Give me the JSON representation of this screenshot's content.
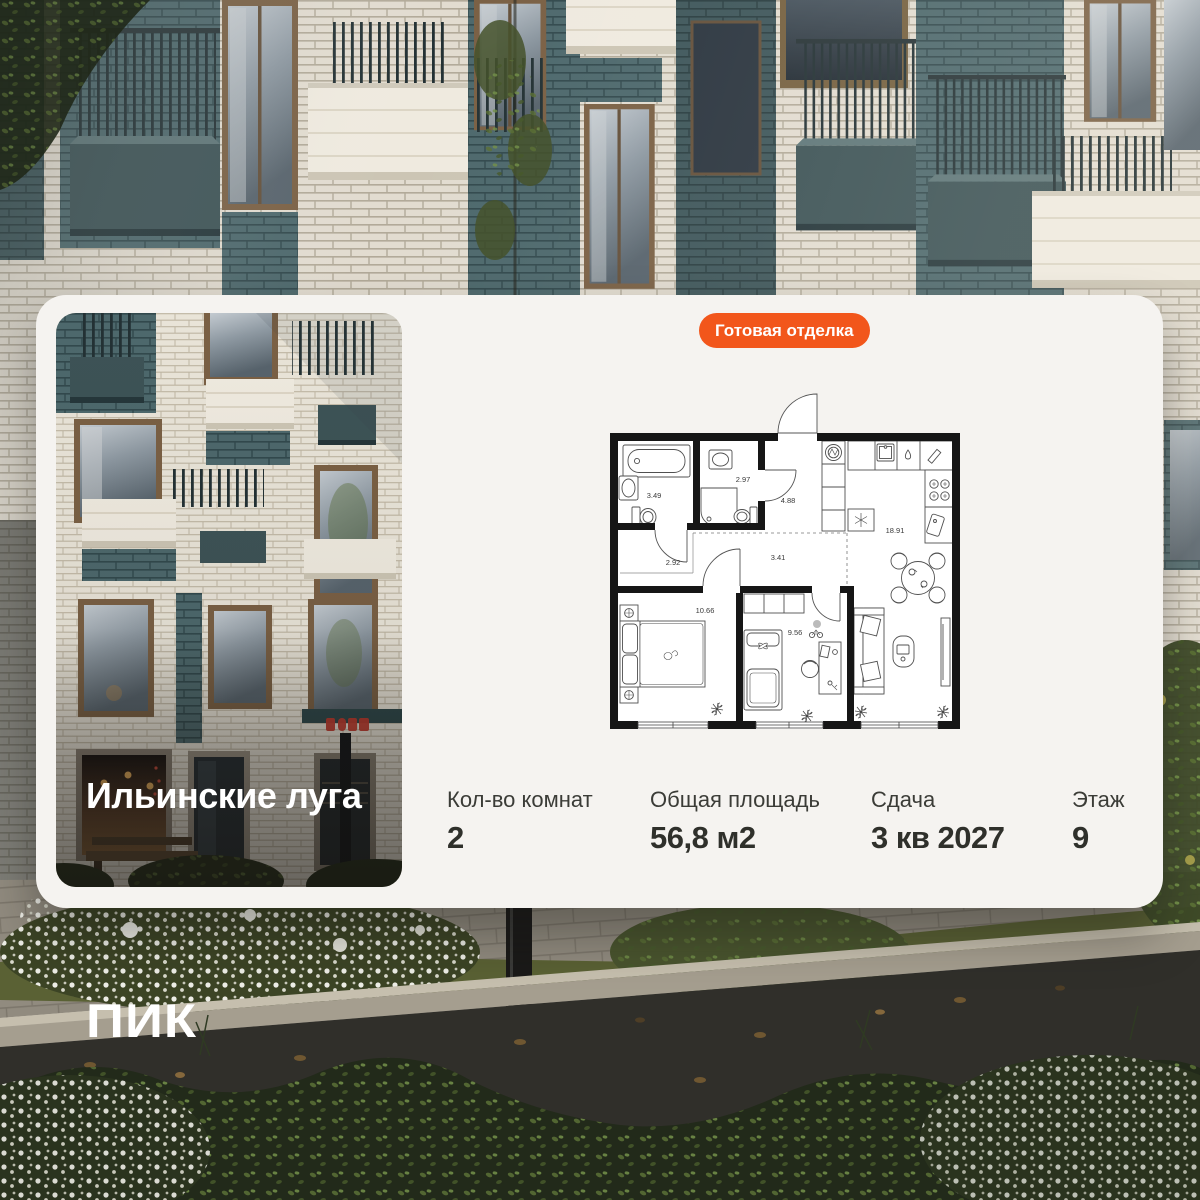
{
  "badge": {
    "label": "Готовая отделка",
    "color": "#F2561B"
  },
  "project": {
    "name": "Ильинские луга"
  },
  "brand": {
    "logo": "ПИК"
  },
  "card": {
    "background": "#F5F3F0"
  },
  "plan": {
    "rooms": [
      {
        "name": "bathroom",
        "area": "3.49"
      },
      {
        "name": "wc",
        "area": "2.97"
      },
      {
        "name": "hallway",
        "area": "4.88"
      },
      {
        "name": "kitchen-living",
        "area": "18.91"
      },
      {
        "name": "corridor",
        "area": "2.92"
      },
      {
        "name": "corridor-2",
        "area": "3.41"
      },
      {
        "name": "bedroom",
        "area": "10.66"
      },
      {
        "name": "room",
        "area": "9.56"
      }
    ]
  },
  "specs": [
    {
      "label": "Кол-во комнат",
      "value": "2"
    },
    {
      "label": "Общая площадь",
      "value": "56,8 м2"
    },
    {
      "label": "Сдача",
      "value": "3 кв 2027"
    },
    {
      "label": "Этаж",
      "value": "9"
    }
  ]
}
